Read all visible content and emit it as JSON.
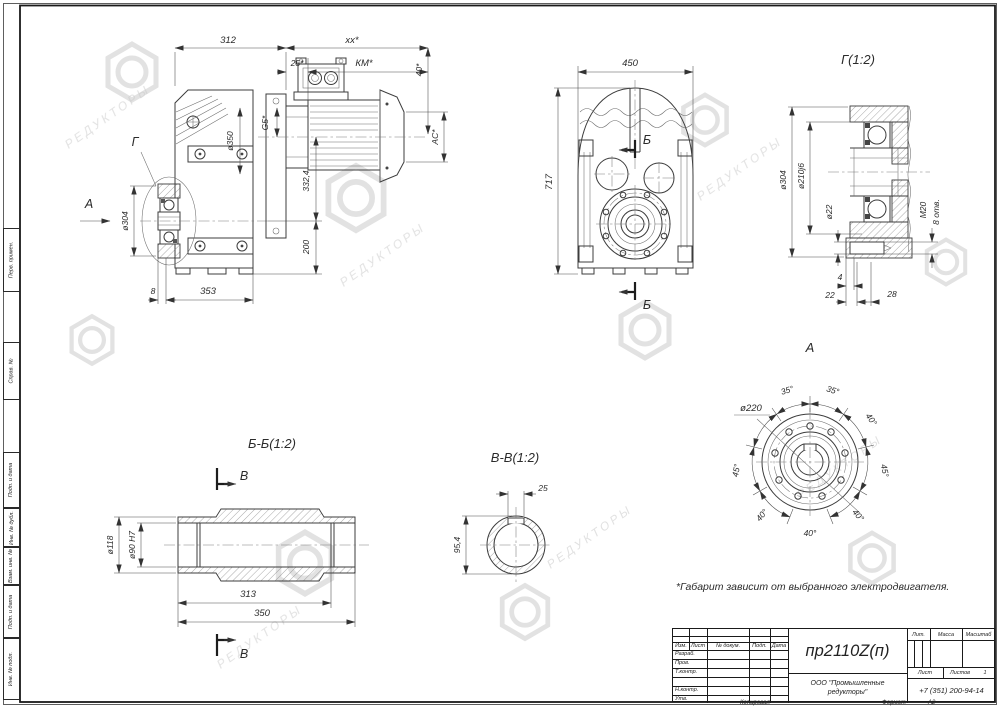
{
  "watermark": {
    "brand": "РЕДУКТОРЫ"
  },
  "notes": {
    "footnote": "*Габарит зависит от выбранного электродвигателя."
  },
  "margin_labels": {
    "perv": "Перв. примен.",
    "sprav": "Справ. №",
    "podp1": "Подп. и дата",
    "inv_dubl": "Инв. № дубл.",
    "vzam": "Взам. инв. №",
    "podp2": "Подп. и дата",
    "inv_podl": "Инв. № подл."
  },
  "views": {
    "side": {
      "d312": "312",
      "dxx": "xx*",
      "d25": "25*",
      "dkm": "КМ*",
      "d40": "40*",
      "dac": "AC*",
      "dg5": "G5*",
      "d350": "ø350",
      "d304": "ø304",
      "d3324": "332,4",
      "d200": "200",
      "d8": "8",
      "d353": "353",
      "lg": "Г",
      "la": "А"
    },
    "front": {
      "d450": "450",
      "d717": "717",
      "lb": "Б"
    },
    "detail_g": {
      "title": "Г(1:2)",
      "d304": "ø304",
      "d210": "ø210j6",
      "d22": "ø22",
      "m20": "M20",
      "otv": "8 отв.",
      "d4": "4",
      "d22b": "22",
      "d28": "28"
    },
    "view_a": {
      "title": "А",
      "d220": "ø220",
      "angles": [
        "35°",
        "35°",
        "40°",
        "45°",
        "40°",
        "40°",
        "40°",
        "45°"
      ]
    },
    "section_bb": {
      "title": "Б-Б(1:2)",
      "d118": "ø118",
      "d90": "ø90 H7",
      "d313": "313",
      "d350": "350",
      "lv": "В"
    },
    "section_vv": {
      "title": "В-В(1:2)",
      "d25": "25",
      "d954": "95,4"
    }
  },
  "stamp": {
    "doc_number": "пр2110Z(п)",
    "company_line1": "ООО \"Промышленные",
    "company_line2": "редукторы\"",
    "phone": "+7 (351) 200-94-14",
    "col_izm": "Изм.",
    "col_list": "Лист",
    "col_doc": "№ докум.",
    "col_podp": "Подп.",
    "col_data": "Дата",
    "row_razrab": "Разраб.",
    "row_prov": "Пров.",
    "row_tkontr": "Т.контр.",
    "row_nkontr": "Н.контр.",
    "row_utv": "Утв.",
    "lit": "Лит.",
    "massa": "Масса",
    "masshtab": "Масштаб",
    "list": "Лист",
    "listov": "Листов",
    "listov_value": "1",
    "kopiroval": "Копировал",
    "format": "Формат",
    "format_value": "А2"
  }
}
